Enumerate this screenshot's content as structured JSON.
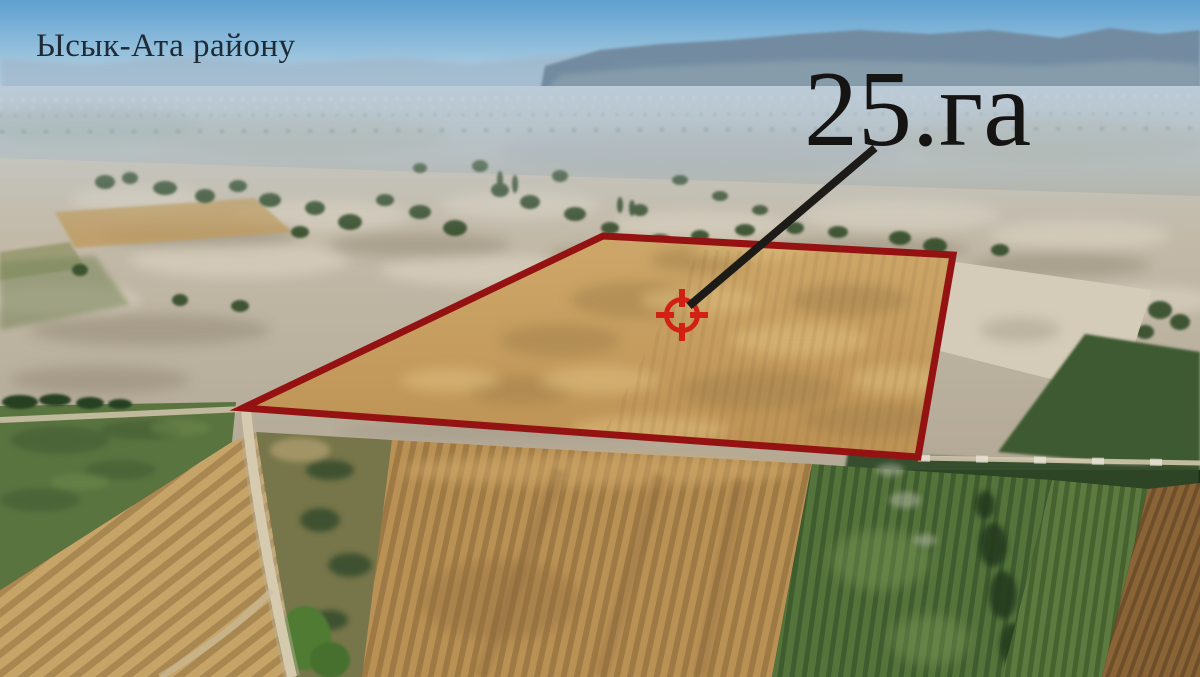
{
  "scene": {
    "region_label": "Ысык-Ата району",
    "area_label": "25.га"
  },
  "plot": {
    "outline_points": "603,236 953,255 918,457 243,408",
    "outline_color": "#951212"
  },
  "marker": {
    "color": "#d22114",
    "position": "translate(682,315)",
    "line_color": "#1c1b17",
    "line": {
      "x1": "875",
      "y1": "148",
      "x2": "689",
      "y2": "306"
    }
  }
}
